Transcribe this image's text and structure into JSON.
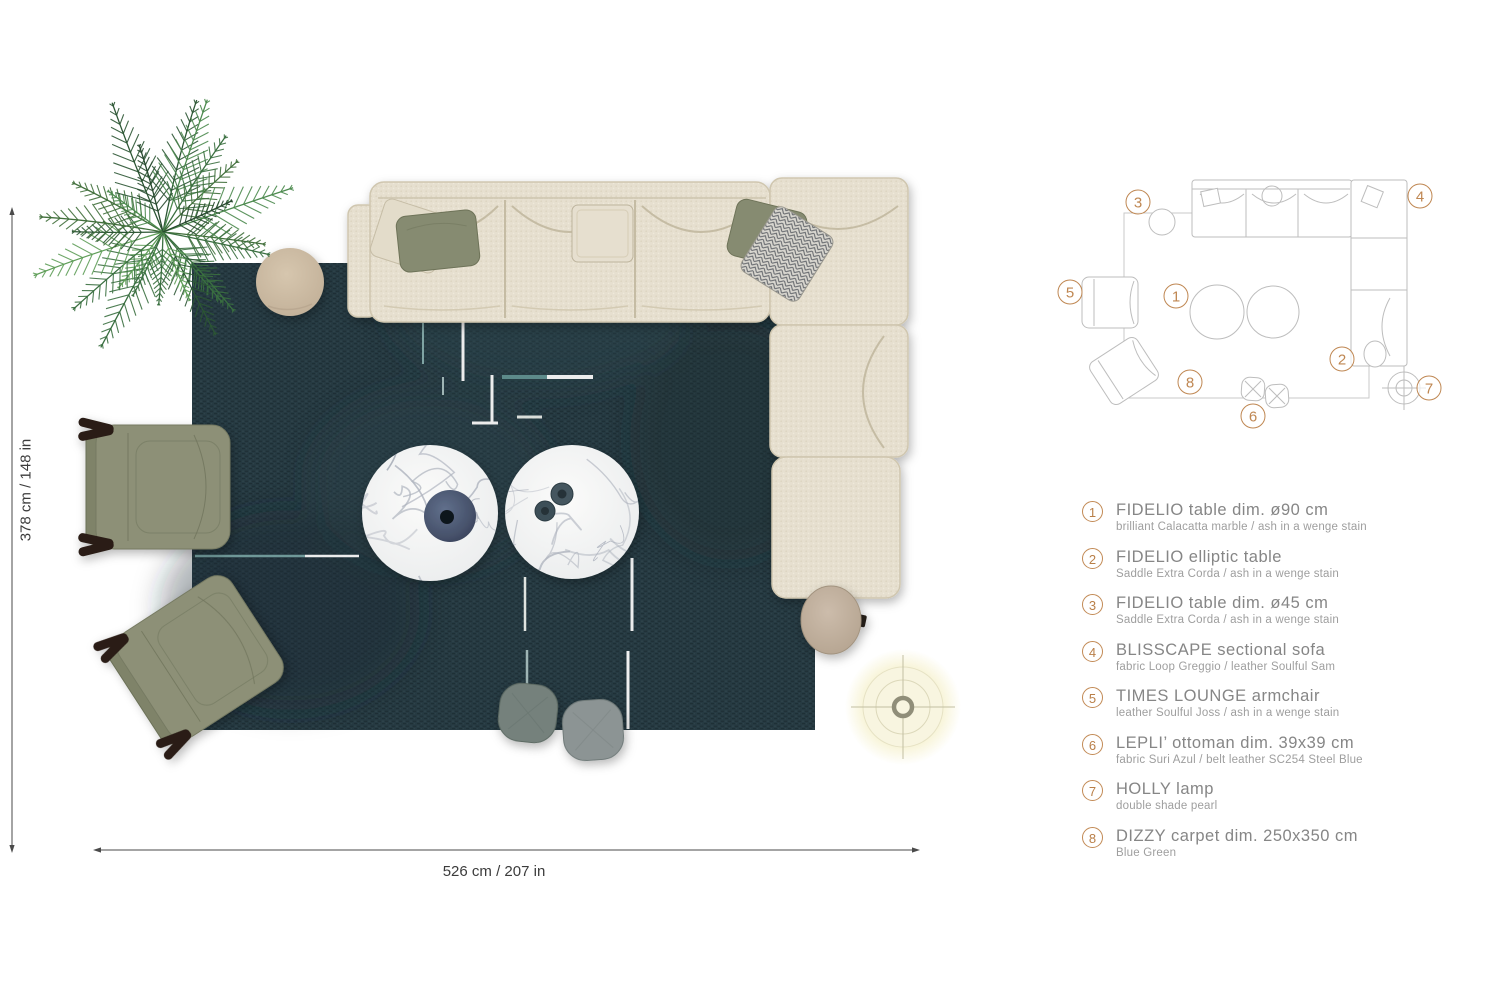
{
  "dimensions": {
    "vertical": "378 cm / 148 in",
    "horizontal": "526 cm / 207 in"
  },
  "plan": {
    "markers": [
      {
        "label": "1"
      },
      {
        "label": "2"
      },
      {
        "label": "3"
      },
      {
        "label": "4"
      },
      {
        "label": "5"
      },
      {
        "label": "6"
      },
      {
        "label": "7"
      },
      {
        "label": "8"
      }
    ]
  },
  "legend": {
    "items": [
      {
        "num": "1",
        "title": "FIDELIO table dim. ø90 cm",
        "subtitle": "brilliant Calacatta marble / ash in a wenge stain"
      },
      {
        "num": "2",
        "title": "FIDELIO elliptic table",
        "subtitle": "Saddle Extra Corda / ash in a wenge stain"
      },
      {
        "num": "3",
        "title": "FIDELIO table dim. ø45 cm",
        "subtitle": "Saddle Extra Corda / ash in a wenge stain"
      },
      {
        "num": "4",
        "title": "BLISSCAPE sectional sofa",
        "subtitle": "fabric Loop Greggio / leather Soulful Sam"
      },
      {
        "num": "5",
        "title": "TIMES LOUNGE armchair",
        "subtitle": "leather Soulful Joss / ash in a wenge stain"
      },
      {
        "num": "6",
        "title": "LEPLI’ ottoman dim. 39x39 cm",
        "subtitle": "fabric Suri Azul / belt leather SC254 Steel Blue"
      },
      {
        "num": "7",
        "title": "HOLLY lamp",
        "subtitle": "double shade pearl"
      },
      {
        "num": "8",
        "title": "DIZZY carpet dim. 250x350 cm",
        "subtitle": "Blue Green"
      }
    ]
  },
  "colors": {
    "accent_orange": "#bf8752",
    "carpet": "#263a42",
    "sofa_fabric": "#e6dfcf",
    "armchair_olive": "#8d9077",
    "pillow_olive": "#868b71",
    "marble": "#f2f3f1",
    "table_tan": "#cbb9a2",
    "lamp_cream": "#f8f5e0",
    "plan_line": "#bdbdbd",
    "palm_green": "#3a6f40"
  }
}
